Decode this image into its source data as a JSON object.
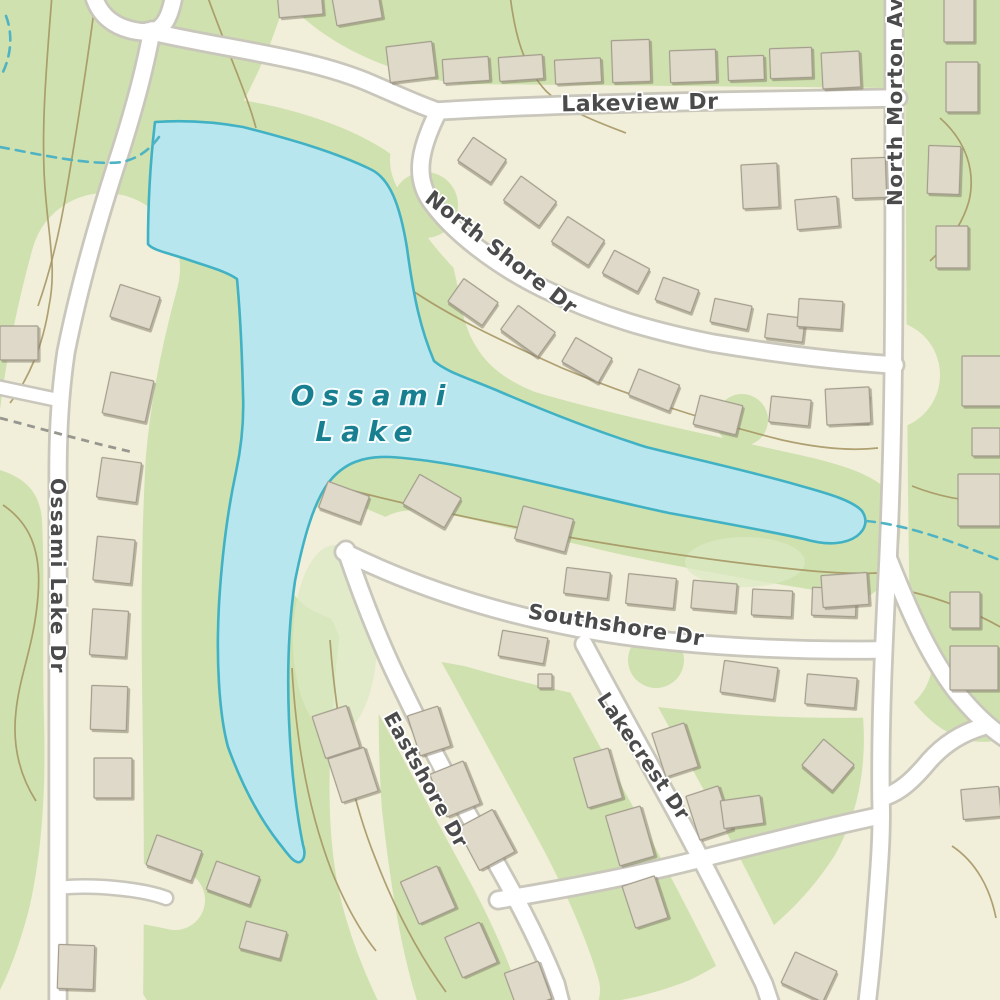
{
  "map": {
    "lake_label": {
      "line1": "Ossami",
      "line2": "Lake"
    },
    "streets": {
      "lakeview": "Lakeview Dr",
      "north_shore": "North Shore Dr",
      "north_morton": "North Morton Ave",
      "ossami_lake_dr": "Ossami Lake Dr",
      "southshore": "Southshore Dr",
      "eastshore": "Eastshore Dr",
      "lakecrest": "Lakecrest Dr"
    },
    "colors": {
      "base": "#f1efda",
      "green": "#cfe1af",
      "green_light": "#dbe8c3",
      "water": "#b7e6ee",
      "water_edge": "#41b1c4",
      "road_fill": "#ffffff",
      "road_casing": "#c9c6bb",
      "building_fill": "#ded9c8",
      "building_edge": "#a39c8d",
      "contour": "#a3925f",
      "stream": "#4fb3c4",
      "path_dash": "#97978f",
      "street_label": "#4b4b4b",
      "water_label": "#187f90"
    },
    "buildings": [
      [
        278,
        -12,
        44,
        28,
        -5
      ],
      [
        334,
        -8,
        46,
        30,
        -10
      ],
      [
        388,
        44,
        46,
        36,
        -7
      ],
      [
        443,
        58,
        46,
        24,
        -4
      ],
      [
        499,
        56,
        44,
        24,
        -4
      ],
      [
        555,
        59,
        46,
        24,
        -3
      ],
      [
        612,
        40,
        38,
        42,
        -2
      ],
      [
        670,
        50,
        46,
        32,
        -2
      ],
      [
        728,
        56,
        36,
        24,
        -2
      ],
      [
        770,
        48,
        42,
        30,
        -2
      ],
      [
        822,
        52,
        38,
        36,
        -3
      ],
      [
        944,
        -2,
        30,
        44,
        0
      ],
      [
        946,
        62,
        32,
        50,
        0
      ],
      [
        928,
        146,
        32,
        48,
        2
      ],
      [
        936,
        226,
        32,
        42,
        0
      ],
      [
        462,
        146,
        40,
        28,
        34
      ],
      [
        508,
        186,
        44,
        30,
        36
      ],
      [
        556,
        226,
        44,
        30,
        33
      ],
      [
        606,
        258,
        40,
        26,
        28
      ],
      [
        658,
        283,
        38,
        24,
        20
      ],
      [
        712,
        302,
        38,
        24,
        12
      ],
      [
        766,
        316,
        38,
        24,
        7
      ],
      [
        798,
        300,
        44,
        28,
        4
      ],
      [
        742,
        164,
        36,
        44,
        -3
      ],
      [
        796,
        198,
        42,
        30,
        -5
      ],
      [
        852,
        158,
        34,
        40,
        -2
      ],
      [
        452,
        288,
        42,
        28,
        35
      ],
      [
        505,
        316,
        46,
        30,
        36
      ],
      [
        566,
        346,
        42,
        28,
        30
      ],
      [
        632,
        376,
        44,
        28,
        22
      ],
      [
        696,
        400,
        44,
        30,
        14
      ],
      [
        770,
        398,
        40,
        26,
        6
      ],
      [
        828,
        394,
        40,
        28,
        3
      ],
      [
        0,
        326,
        38,
        34,
        0
      ],
      [
        114,
        290,
        42,
        34,
        18
      ],
      [
        106,
        376,
        44,
        42,
        12
      ],
      [
        99,
        460,
        40,
        40,
        8
      ],
      [
        95,
        538,
        38,
        44,
        6
      ],
      [
        91,
        610,
        36,
        46,
        4
      ],
      [
        91,
        686,
        36,
        44,
        2
      ],
      [
        94,
        758,
        38,
        40,
        0
      ],
      [
        150,
        842,
        48,
        32,
        20
      ],
      [
        210,
        868,
        46,
        30,
        20
      ],
      [
        58,
        945,
        36,
        44,
        2
      ],
      [
        242,
        926,
        42,
        28,
        15
      ],
      [
        322,
        488,
        44,
        28,
        20
      ],
      [
        408,
        484,
        48,
        34,
        30
      ],
      [
        518,
        512,
        52,
        34,
        15
      ],
      [
        565,
        570,
        44,
        26,
        7
      ],
      [
        627,
        576,
        48,
        30,
        6
      ],
      [
        692,
        582,
        44,
        28,
        5
      ],
      [
        752,
        590,
        40,
        26,
        3
      ],
      [
        812,
        588,
        44,
        28,
        2
      ],
      [
        500,
        634,
        46,
        26,
        10
      ],
      [
        538,
        674,
        14,
        14,
        0
      ],
      [
        722,
        664,
        54,
        32,
        8
      ],
      [
        806,
        676,
        50,
        30,
        5
      ],
      [
        318,
        710,
        36,
        44,
        -18
      ],
      [
        413,
        710,
        32,
        42,
        -18
      ],
      [
        334,
        752,
        38,
        46,
        -18
      ],
      [
        437,
        766,
        36,
        46,
        -22
      ],
      [
        466,
        816,
        40,
        48,
        -28
      ],
      [
        408,
        872,
        40,
        46,
        -24
      ],
      [
        452,
        928,
        38,
        44,
        -24
      ],
      [
        510,
        966,
        36,
        40,
        -20
      ],
      [
        580,
        752,
        36,
        52,
        -16
      ],
      [
        612,
        810,
        36,
        52,
        -16
      ],
      [
        658,
        727,
        34,
        46,
        -18
      ],
      [
        692,
        790,
        34,
        46,
        -18
      ],
      [
        628,
        880,
        34,
        44,
        -18
      ],
      [
        786,
        960,
        46,
        34,
        25
      ],
      [
        722,
        798,
        40,
        28,
        -8
      ],
      [
        808,
        748,
        40,
        34,
        40
      ],
      [
        962,
        788,
        38,
        30,
        -5
      ],
      [
        826,
        388,
        44,
        36,
        -3
      ],
      [
        822,
        574,
        46,
        32,
        -4
      ],
      [
        962,
        356,
        40,
        50,
        0
      ],
      [
        972,
        428,
        28,
        28,
        0
      ],
      [
        958,
        474,
        42,
        52,
        0
      ],
      [
        950,
        592,
        30,
        36,
        0
      ],
      [
        950,
        646,
        48,
        44,
        0
      ]
    ]
  }
}
